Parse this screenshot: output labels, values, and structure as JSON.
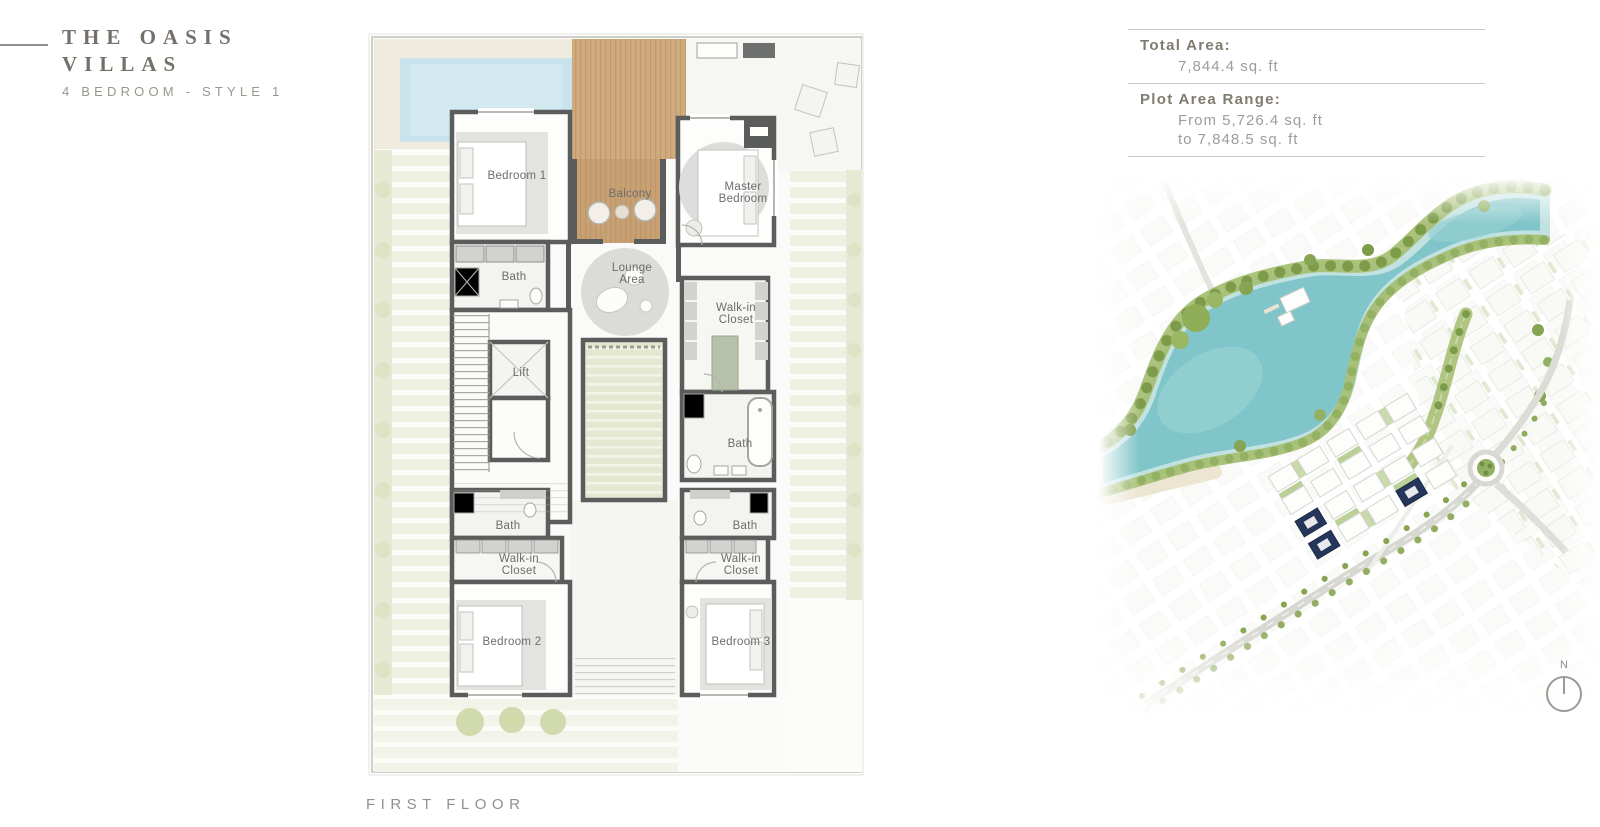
{
  "header": {
    "title_line1": "THE OASIS",
    "title_line2": "VILLAS",
    "subtitle": "4 BEDROOM - STYLE 1"
  },
  "area_panel": {
    "total_area_label": "Total Area:",
    "total_area_value": "7,844.4 sq. ft",
    "plot_area_label": "Plot Area Range:",
    "plot_area_from": "From 5,726.4 sq. ft",
    "plot_area_to": "to 7,848.5 sq. ft"
  },
  "floor_plan": {
    "floor_label": "FIRST FLOOR",
    "rooms": {
      "bedroom1": "Bedroom 1",
      "balcony": "Balcony",
      "master_line1": "Master",
      "master_line2": "Bedroom",
      "bath_top": "Bath",
      "lounge_line1": "Lounge",
      "lounge_line2": "Area",
      "wic_master_line1": "Walk-in",
      "wic_master_line2": "Closet",
      "lift": "Lift",
      "bath_master": "Bath",
      "bath_lower_left": "Bath",
      "bath_lower_right": "Bath",
      "wic_left_line1": "Walk-in",
      "wic_left_line2": "Closet",
      "wic_right_line1": "Walk-in",
      "wic_right_line2": "Closet",
      "bedroom2": "Bedroom 2",
      "bedroom3": "Bedroom 3"
    }
  },
  "site_map": {
    "north_label": "N"
  },
  "colors": {
    "wall": "#5b5d5c",
    "wood_deck": "#cfab7d",
    "pool": "#c8e3eb",
    "courtyard": "#e4e8d1",
    "lake": "#80c5c9",
    "greenery": "#a6bf74",
    "highlight_villa": "#26365a",
    "accent_text": "#75716a"
  }
}
